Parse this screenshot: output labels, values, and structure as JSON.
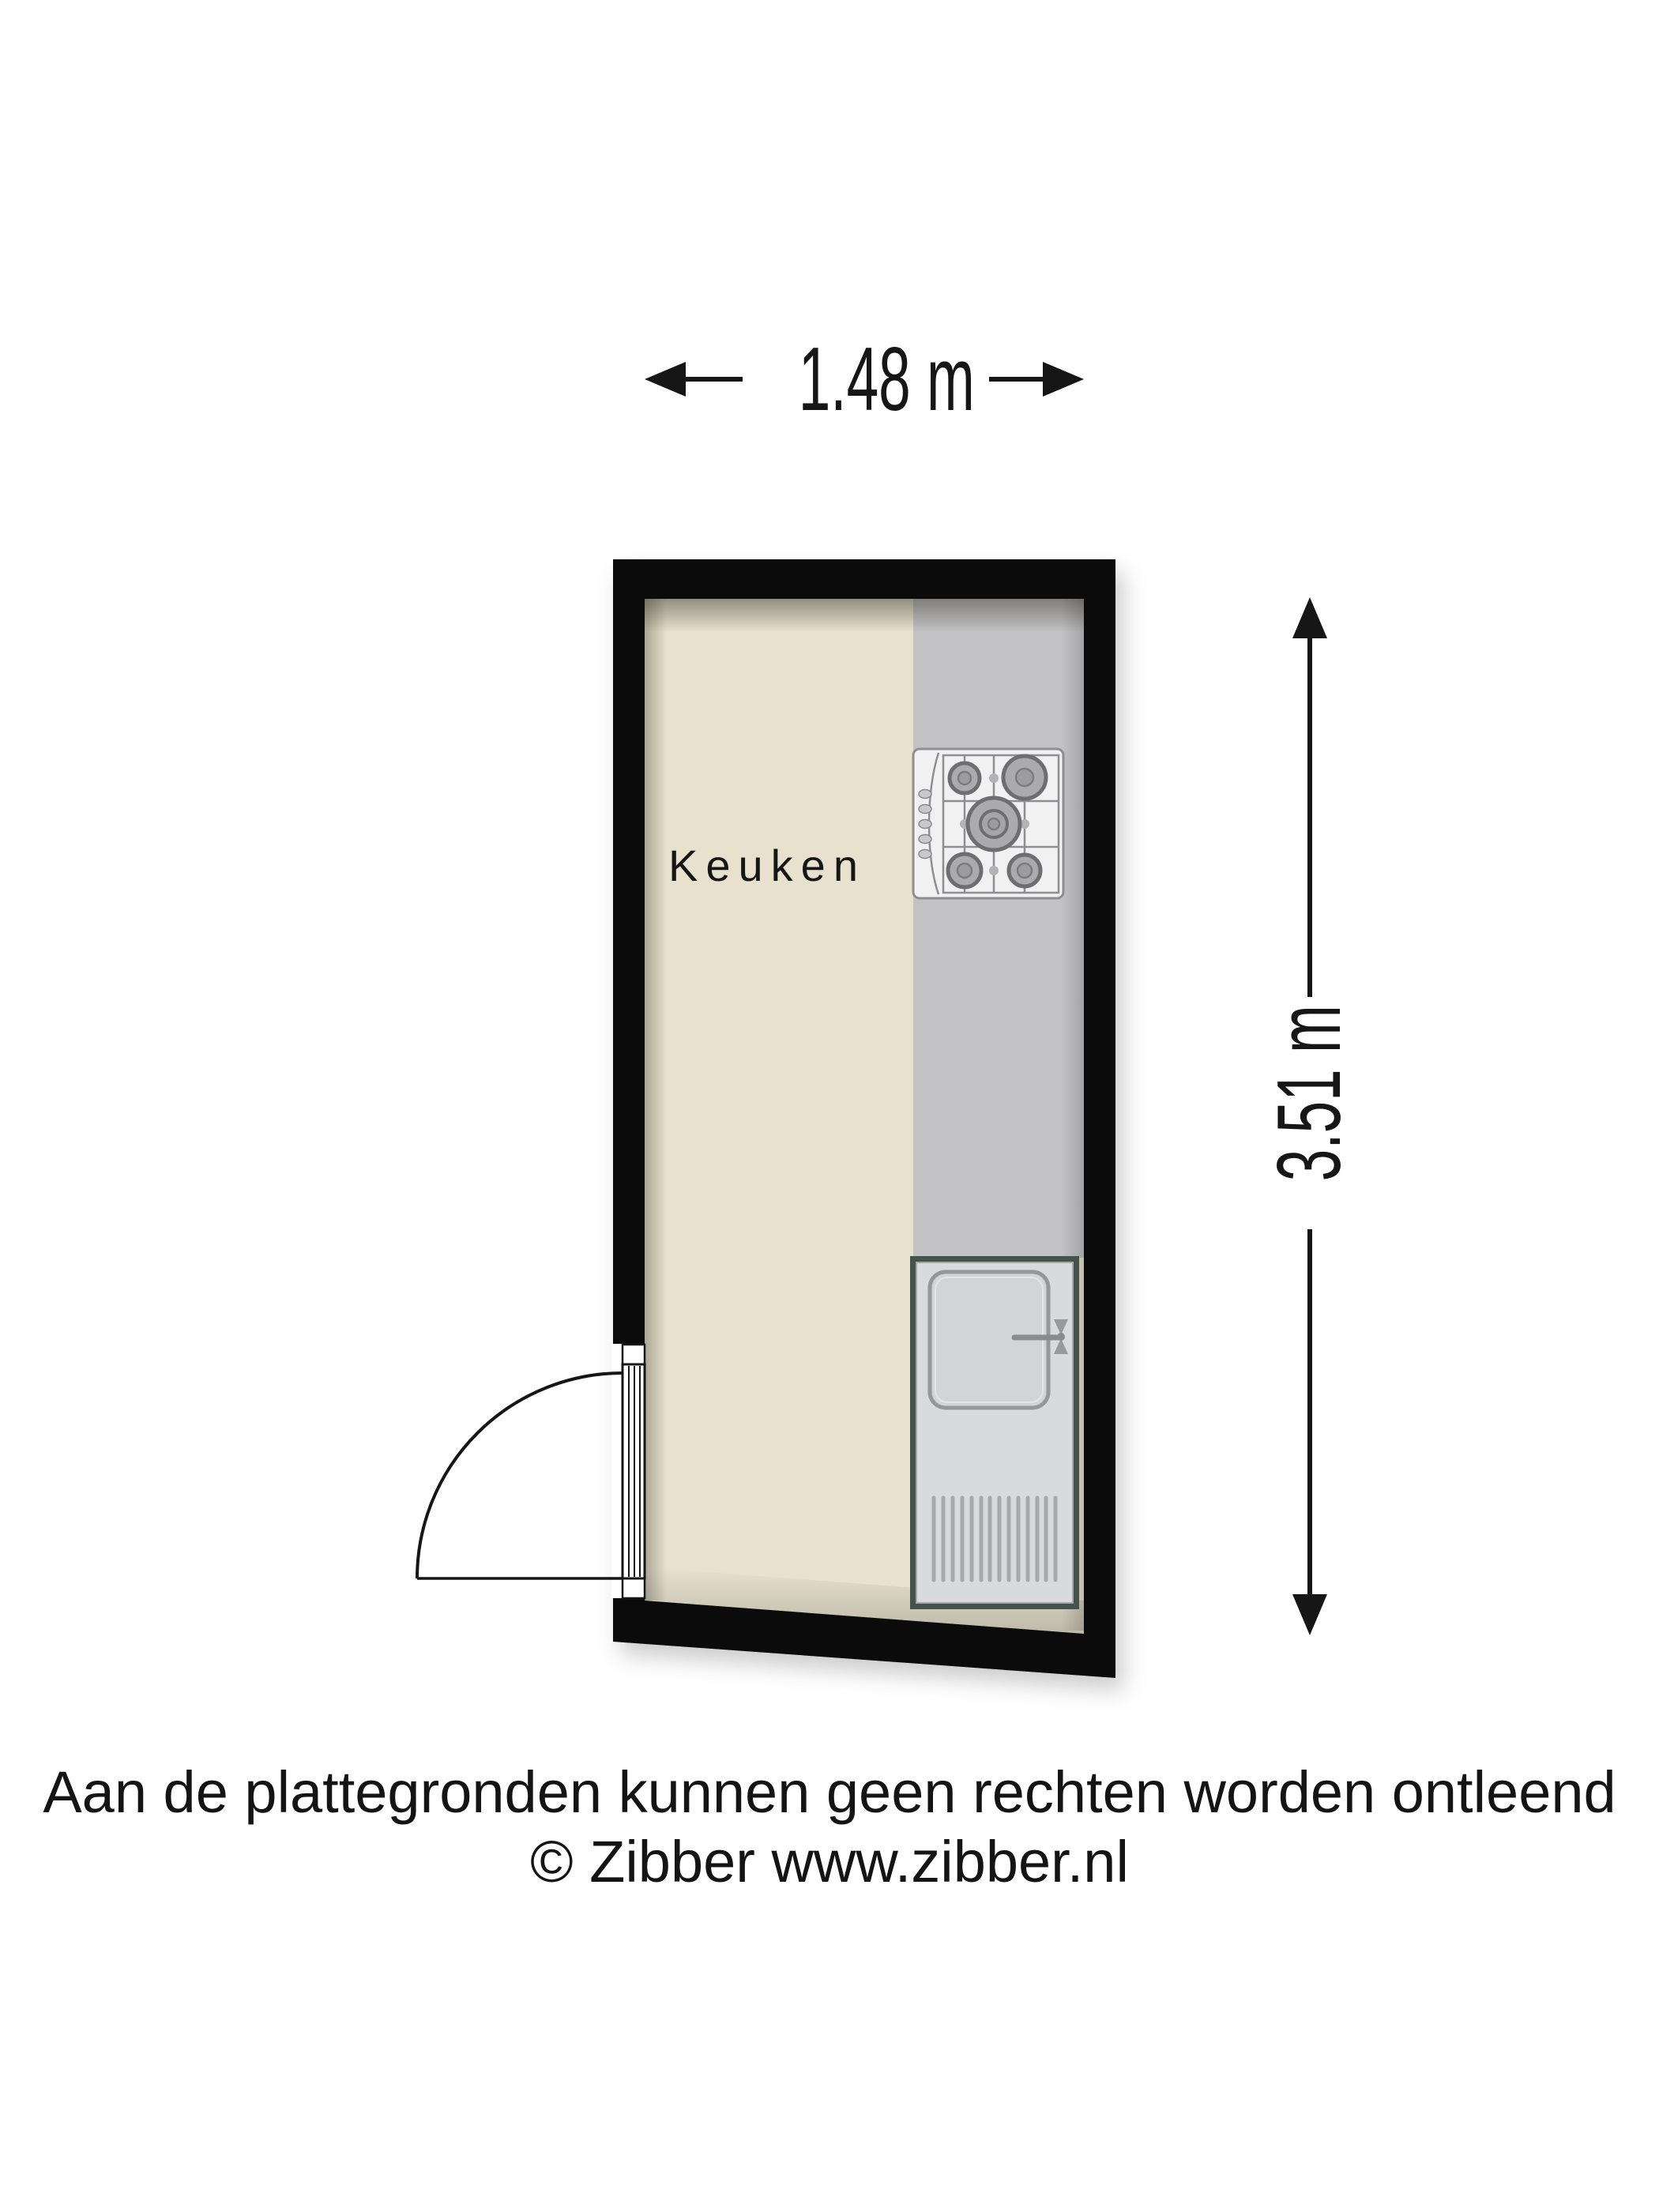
{
  "title": "Keuken plattegrond",
  "floor_plan": {
    "room": {
      "label": "Keuken"
    },
    "dimensions": {
      "width_label": "1.48 m",
      "height_label": "3.51 m"
    },
    "fixtures": {
      "stove": "gas-hob-icon",
      "sink": "kitchen-sink-icon",
      "door": "door-swing-icon",
      "width_arrow": "horizontal-dimension-arrow-icon",
      "height_arrow": "vertical-dimension-arrow-icon"
    }
  },
  "disclaimer": {
    "line1": "Aan de plattegronden kunnen geen rechten worden ontleend",
    "line2": "© Zibber www.zibber.nl"
  },
  "colors": {
    "wall": "#0b0b0b",
    "floor": "#e7e1cd",
    "counter": "#c2c2c4",
    "sink-border": "#46534c",
    "sink-panel": "#d9dadc",
    "appliance": "#8f8f91",
    "ink": "#161616"
  }
}
